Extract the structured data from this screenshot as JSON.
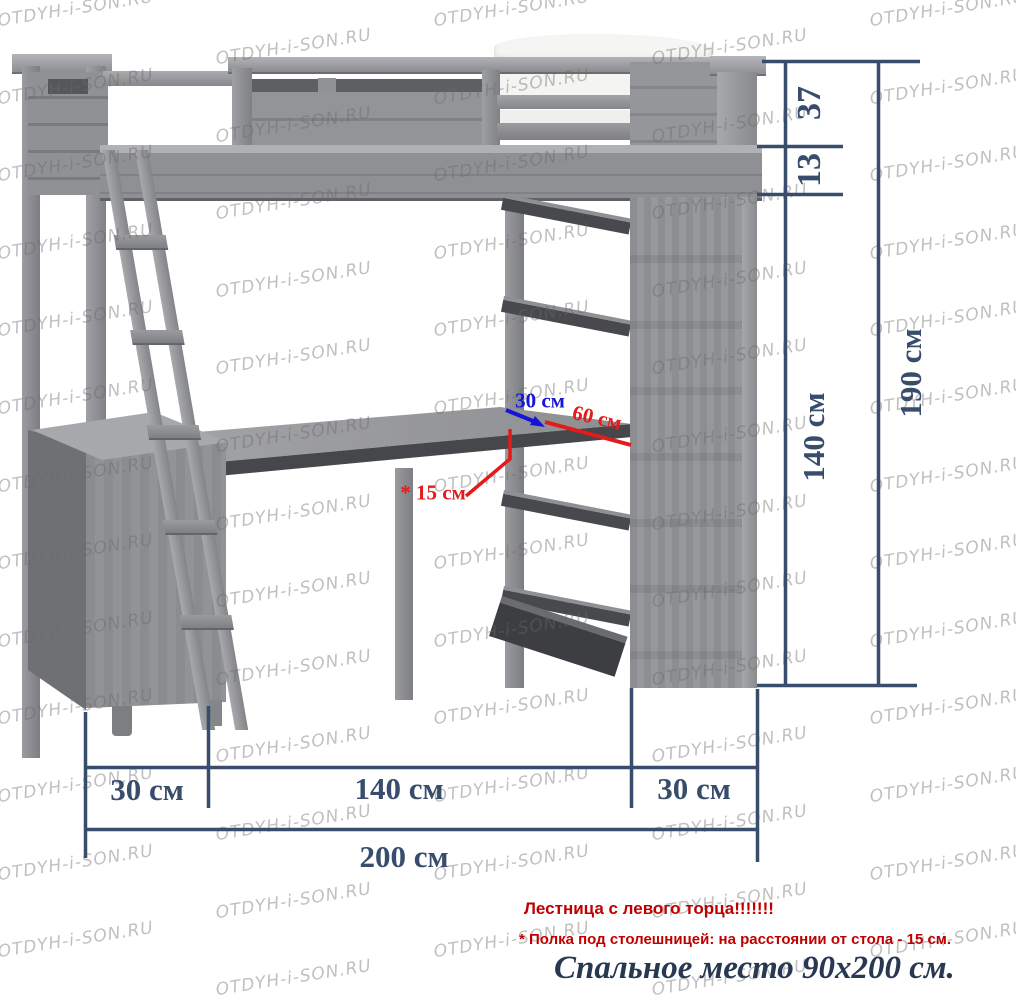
{
  "watermark": {
    "text": "OTDYH-i-SON.RU"
  },
  "colors": {
    "dimension_navy": "#374d6b",
    "annotation_blue": "#1515d8",
    "annotation_red": "#e31b1b",
    "note_red": "#c00000",
    "note_dark": "#273850"
  },
  "dimensions": {
    "height_37": "37",
    "height_13": "13",
    "height_140": "140 см",
    "height_190": "190 см",
    "width_30_left": "30 см",
    "width_140": "140 см",
    "width_30_right": "30 см",
    "width_200": "200 см",
    "depth_30": "30 см",
    "depth_60": "60 см",
    "shelf_gap_15": "* 15 см"
  },
  "notes": {
    "ladder": "Лестница с левого торца!!!!!!!",
    "shelf": "* Полка под столешницей: на расстоянии от стола - 15 см.",
    "bed": "Спальное место 90x200 см."
  }
}
